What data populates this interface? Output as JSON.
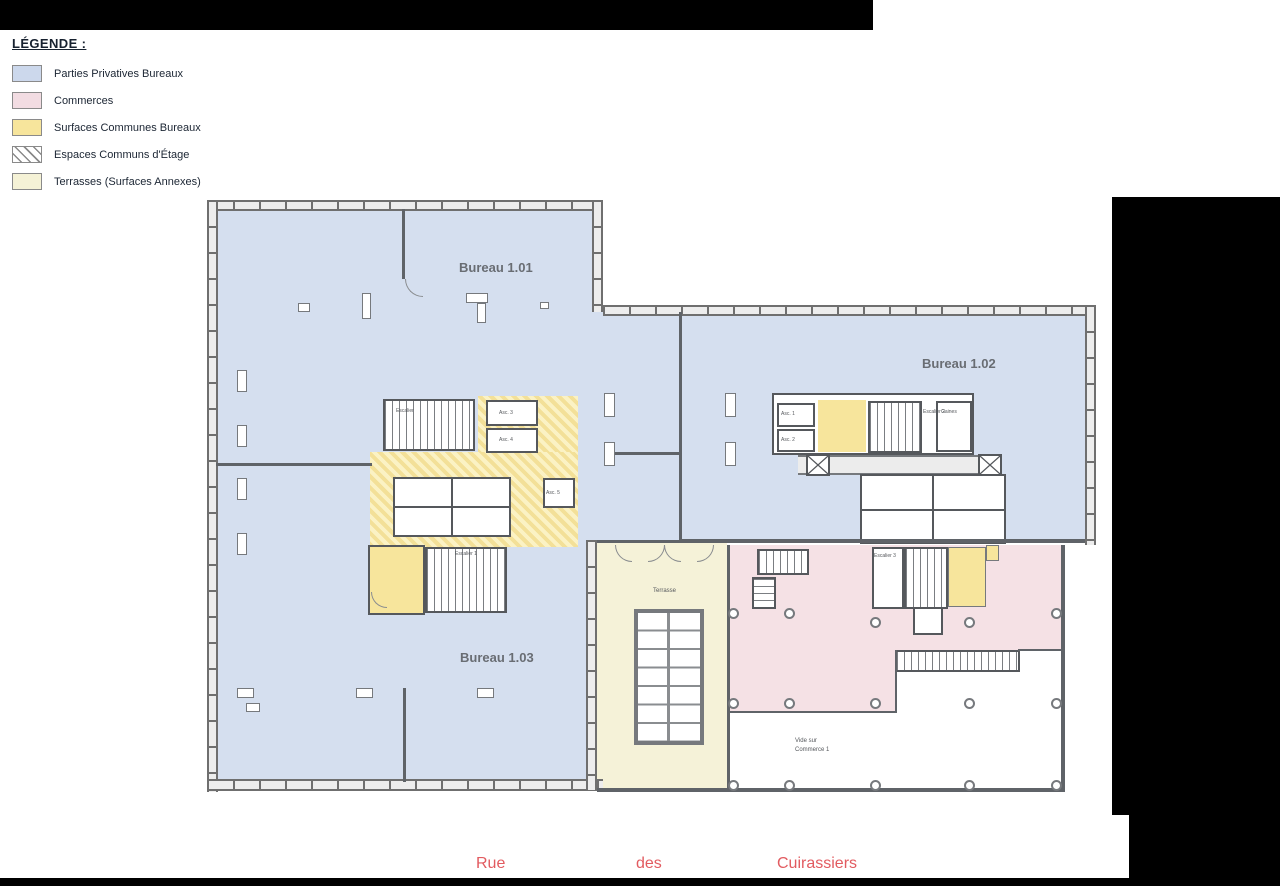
{
  "legend": {
    "title": "LÉGENDE :",
    "items": [
      {
        "label": "Parties Privatives Bureaux",
        "color": "#ccd8ec",
        "swatch": "blue"
      },
      {
        "label": "Commerces",
        "color": "#f2dce2",
        "swatch": "pink"
      },
      {
        "label": "Surfaces Communes Bureaux",
        "color": "#f7e59c",
        "swatch": "yellow"
      },
      {
        "label": "Espaces Communs d'Étage",
        "color": "hatched-gray-on-white",
        "swatch": "hatch"
      },
      {
        "label": "Terrasses (Surfaces Annexes)",
        "color": "#f5f2d6",
        "swatch": "pale"
      }
    ]
  },
  "plan": {
    "rooms": {
      "bureau101": "Bureau 1.01",
      "bureau102": "Bureau 1.02",
      "bureau103": "Bureau 1.03",
      "terrasse": "Terrasse",
      "vide1": "Vide sur",
      "vide2": "Commerce 1"
    },
    "core_labels": {
      "asc1": "Asc. 1",
      "asc2": "Asc. 2",
      "asc3": "Asc. 3",
      "asc4": "Asc. 4",
      "asc5": "Asc. 5",
      "escalier": "Escalier",
      "escalier1": "Escalier 1",
      "escalier2": "Escalier 2",
      "escalier3": "Escalier 3",
      "gaines": "Gaines"
    }
  },
  "street": {
    "words": [
      "Rue",
      "des",
      "Cuirassiers"
    ],
    "color": "#e25b60"
  },
  "colors": {
    "private_offices_blue": "#d5dfef",
    "commerces_pink": "#f5e1e5",
    "common_surfaces_yellow": "#f7e59c",
    "terrace_pale_yellow": "#f5f2d8",
    "wall_gray": "#6f6f6f",
    "room_label_gray": "#696d73",
    "street_red": "#e25b60"
  }
}
